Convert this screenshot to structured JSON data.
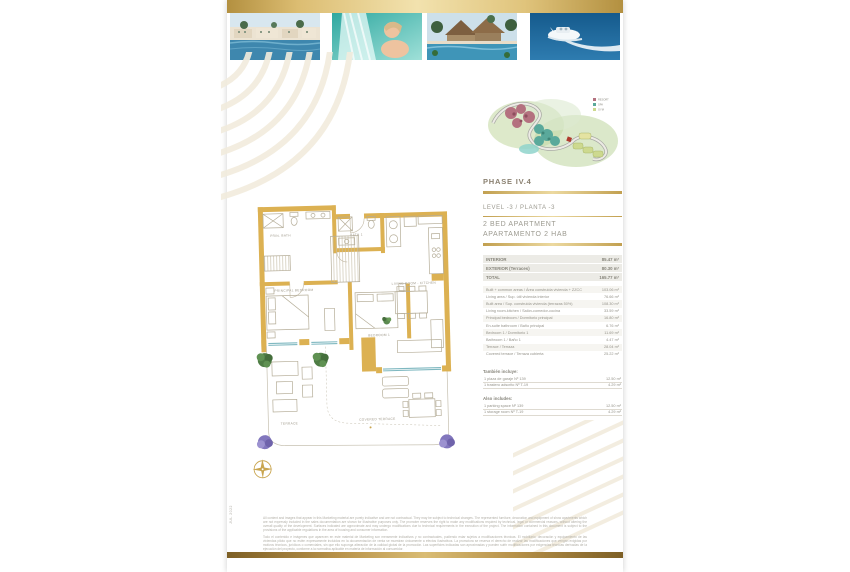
{
  "page": {
    "date_side": "JUL 2022"
  },
  "photos": {
    "photo1_name": "resort-pool-photo",
    "photo2_name": "spa-waterfall-photo",
    "photo3_name": "tropical-resort-photo",
    "photo4_name": "catamaran-photo"
  },
  "masterplan": {
    "phase_label": "PHASE IV.4",
    "legend": [
      {
        "label": "RESORT",
        "color": "#b4717f"
      },
      {
        "label": "SPA",
        "color": "#5aa99b"
      },
      {
        "label": "GYM",
        "color": "#cdd98f"
      }
    ]
  },
  "unit": {
    "level": "LEVEL -3 / PLANTA -3",
    "type_line1": "2 BED APARTMENT",
    "type_line2": "APARTAMENTO 2 HAB"
  },
  "areas": {
    "summary": [
      {
        "label": "INTERIOR",
        "value": "85.47 m²"
      },
      {
        "label": "EXTERIOR (Terraces)",
        "value": "80.30 m²"
      },
      {
        "label": "TOTAL",
        "value": "165.77 m²"
      }
    ],
    "details": [
      {
        "label": "Built + common areas / Área construida vivienda + ZZCC",
        "value": "103.06 m²"
      },
      {
        "label": "Living area / Sup. útil vivienda interior",
        "value": "76.66 m²"
      },
      {
        "label": "Built area / Sup. construida vivienda (terrazas 50%)",
        "value": "108.30 m²"
      },
      {
        "label": "Living room-kitchen / Salón-comedor-cocina",
        "value": "33.59 m²"
      },
      {
        "label": "Principal bedroom / Dormitorio principal",
        "value": "16.80 m²"
      },
      {
        "label": "En-suite bathroom / Baño principal",
        "value": "6.76 m²"
      },
      {
        "label": "Bedroom 1 / Dormitorio 1",
        "value": "11.69 m²"
      },
      {
        "label": "Bathroom 1 / Baño 1",
        "value": "4.47 m²"
      },
      {
        "label": "Terrace / Terraza",
        "value": "28.04 m²"
      },
      {
        "label": "Covered terrace / Terraza cubierta",
        "value": "25.22 m²"
      }
    ],
    "also_includes_es": {
      "title": "También incluye:",
      "rows": [
        {
          "label": "1 plaza de garaje Nº 139",
          "value": "12.50 m²"
        },
        {
          "label": "1 trastero adscrito Nº T-19",
          "value": "4.29 m²"
        }
      ]
    },
    "also_includes_en": {
      "title": "Also includes:",
      "rows": [
        {
          "label": "1 parking space Nº 139",
          "value": "12.50 m²"
        },
        {
          "label": "1 storage room Nº T-19",
          "value": "4.29 m²"
        }
      ]
    }
  },
  "floorplan": {
    "labels": {
      "prin_bath": "PRIN. BATH",
      "bath_1": "BATH 1",
      "principal_bedroom": "PRINCIPAL BEDROOM",
      "bedroom_1": "BEDROOM 1",
      "living": "LIVING ROOM - KITCHEN",
      "terrace": "TERRACE",
      "covered_terrace": "COVERED TERRACE"
    }
  },
  "footer": {
    "disclaimer_en": "All content and images that appear in this Marketing material are purely indicative and are not contractual. They may be subject to technical changes. The represented furniture, decoration and equipment of show apartments which are not expressly included in the sales documentation are shown for illustrative purposes only. The promoter reserves the right to make any modifications required by technical, legal or commercial reasons, without altering the overall quality of the development. Surfaces indicated are approximate and may undergo modifications due to technical requirements in the execution of the project. The information contained in this document is subject to the provisions of the applicable regulations in the area of housing and consumer information.",
    "disclaimer_es": "Todo el contenido e imágenes que aparecen en este material de Marketing son meramente indicativos y no contractuales, pudiendo estar sujetos a modificaciones técnicas. El mobiliario, decoración y equipamiento de las viviendas piloto que no estén expresamente incluidos en la documentación de venta se muestran únicamente a efectos ilustrativos. La promotora se reserva el derecho de realizar las modificaciones que vengan exigidas por motivos técnicos, jurídicos o comerciales, sin que ello suponga alteración de la calidad global de la promoción. Las superficies indicadas son aproximadas y pueden sufrir modificaciones por exigencias técnicas derivadas de la ejecución del proyecto, conforme a la normativa aplicable en materia de información al consumidor."
  },
  "colors": {
    "gold": "#C9A54F",
    "gold_light": "#F2E2AE",
    "gold_dark": "#7D5F25",
    "heading_text": "#8A8070",
    "body_text": "#95938A"
  }
}
